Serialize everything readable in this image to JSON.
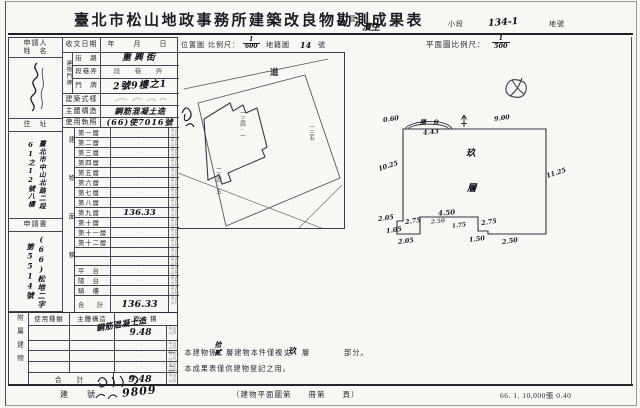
{
  "colors": {
    "paper": "#f8f7f3",
    "ink": "#2b2b31",
    "pencil": "#b0aea7"
  },
  "header": {
    "title": "臺北市松山地政事務所建築改良物勘測成果表",
    "district_value": "山",
    "district_label": "區",
    "section_value": "濱生",
    "section_label": "段",
    "subsection_label": "小段",
    "parcel_value": "134-1",
    "parcel_label": "地號"
  },
  "left_form": {
    "applicant_label_1": "申請人",
    "applicant_label_2": "姓　名",
    "address_label": "住　址",
    "address_value": "臺北市中山北路二段61之12號八樓",
    "application_label": "申請書",
    "application_value": "(66)松地二字第5514號",
    "receipt_label": "收文日期",
    "receipt_value": "年　月　日",
    "doorplate_label": "建物門牌",
    "street_label": "街　路",
    "street_value": "重興街",
    "lane_label": "段巷弄",
    "lane_value": "段　巷　弄",
    "door_label": "門　牌",
    "door_value": "2號9樓之1",
    "style_label": "建築式樣",
    "structure_label": "主體構造",
    "structure_value": "鋼筋混凝土造",
    "license_label": "使用執照",
    "license_value": "(66)使7016號",
    "area_label": "建物面積",
    "unit": "平方公尺",
    "floors": [
      {
        "label": "第一層",
        "value": "·"
      },
      {
        "label": "第二層",
        "value": "·"
      },
      {
        "label": "第三層",
        "value": "·"
      },
      {
        "label": "第四層",
        "value": "·"
      },
      {
        "label": "第五層",
        "value": "·"
      },
      {
        "label": "第六層",
        "value": "·"
      },
      {
        "label": "第七層",
        "value": "·"
      },
      {
        "label": "第八層",
        "value": "·"
      },
      {
        "label": "第九層",
        "value": "136.33"
      },
      {
        "label": "第十層",
        "value": "·"
      },
      {
        "label": "第十一層",
        "value": "·"
      },
      {
        "label": "第十二層",
        "value": "·"
      },
      {
        "label": "",
        "value": "·"
      },
      {
        "label": "",
        "value": "·"
      },
      {
        "label": "平　台",
        "value": "·"
      },
      {
        "label": "陽　台",
        "value": "·"
      },
      {
        "label": "騎　樓",
        "value": "·"
      }
    ],
    "total_label": "合　計",
    "total_value": "136.33"
  },
  "annex": {
    "label": "附屬建物",
    "h_type": "使用種類",
    "h_structure": "主體構造",
    "h_area": "面　積",
    "structure_value": "鋼筋混凝土造",
    "r1_area": "9.48",
    "dot": "·",
    "total_label": "合　計",
    "total_value": "9.48"
  },
  "site_map": {
    "label": "位置圖",
    "scale_label": "比例尺：",
    "scale_num": "1",
    "scale_den": "600",
    "cadastre_label": "地籍圖",
    "sheet_no": "14",
    "sheet_label": "號",
    "road": "道",
    "parcel_main": "一三四-一",
    "parcel_sw": "一三四-五",
    "parcel_e": "一三五"
  },
  "floor_plan": {
    "header": "平面圖比例尺：",
    "scale_num": "1",
    "scale_den": "500",
    "balcony": "陽台",
    "floor_char_1": "玖",
    "floor_char_2": "層",
    "dims": {
      "top_left": "0.60",
      "balcony_w": "4.43",
      "top": "9.00",
      "left": "10.25",
      "right": "11.25",
      "b1": "2.05",
      "b2": "1.05",
      "b3": "2.05",
      "b4": "2.75",
      "b5": "4.50",
      "b6": "2.50",
      "b7": "1.75",
      "b8": "2.75",
      "b9": "1.50",
      "b10": "2.50"
    }
  },
  "notes": {
    "l1a": "一、本建物係",
    "fill1": "拾貳",
    "l1b": "層建物本件僅複丈",
    "fill2": "玖",
    "l1c": "層",
    "l1d": "部分。",
    "l2": "二、本成果表僅供建物登記之用。"
  },
  "footer": {
    "building_no_label": "建　　號",
    "handwritten_no": "9809",
    "plan_page": "（建物平面圖第　　冊第　　頁）",
    "print_info": "66. 1. 10,000張 0.40"
  }
}
